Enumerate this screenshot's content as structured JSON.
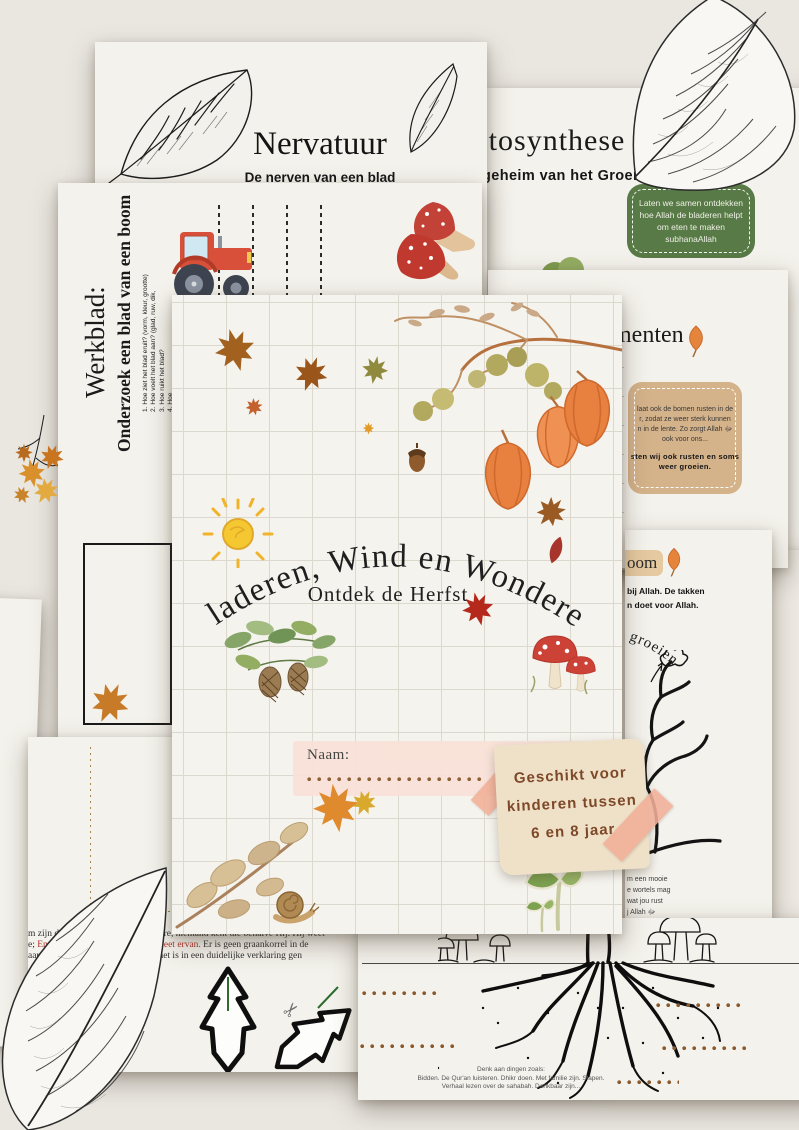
{
  "cover": {
    "title": "Bladeren, Wind en Wonderen",
    "subtitle": "Ontdek de Herfst",
    "name_label": "Naam:",
    "note_lines": [
      "Geschikt voor",
      "kinderen tussen",
      "6 en 8 jaar"
    ]
  },
  "nervatuur": {
    "title": "Nervatuur",
    "subtitle": "De nerven van een blad"
  },
  "fotosynthese": {
    "title": "Fotosynthese",
    "subtitle": "Het geheim van het Groene Blad",
    "badge_lines": [
      "Laten we samen ontdekken",
      "hoe Allah de bladeren helpt",
      "om eten te maken",
      "subhanaAllah"
    ]
  },
  "werkblad": {
    "title": "Werkblad:",
    "subtitle": "Onderzoek een blad van een boom",
    "items": [
      "1.  Hoe ziet het blad eruit? (vorm, kleur, grootte)",
      "2.  Hoe voelt het blad aan? (glad, ruw, dik,",
      "3.  Hoe ruikt het blad?",
      "4.  Hoe"
    ]
  },
  "experimenten": {
    "title_partial": "menten",
    "box_lines": [
      "laat ook de bomen rusten in de",
      "r, zodat ze weer sterk kunnen",
      "n in de lente. Zo zorgt Allah ﷻ",
      "ook voor ons..."
    ],
    "box_bold_lines": [
      "sten wij ook rusten en soms",
      "weer groeien."
    ]
  },
  "boom": {
    "badge_partial": "oom",
    "line1": "bij Allah. De takken",
    "line2": "n doet voor Allah.",
    "arc_text": "groeien",
    "bottom_lines": [
      "m een mooie",
      "e wortels mag",
      "wat jou rust",
      "j Allah ﷻ"
    ]
  },
  "ayah": {
    "arabic_line1": "وَيَعْلَمُ مَا",
    "arabic_line2": "إِلَّا يَعْلَمُهَا",
    "arabic_line3": "وَلَا يَابِسٍ",
    "trans_line1": "m zijn de sleutels van het onzichtbare, niemand kent die behalve Hij. Hij weet",
    "trans_line2_pre": "e; ",
    "trans_line2_red": "En er valt nog geen blad of Hij weet ervan.",
    "trans_line2_post": " Er is geen graankorrel in de",
    "trans_line3": "aarde, noch iets' vers of droogs of het is in een duidelijke verklaring gen"
  },
  "roots": {
    "hint_lines": [
      "Denk aan dingen zoals:",
      "Bidden. De Qur'an luisteren. Dhikr doen. Met familie zijn. Slapen.",
      "Verhaal lezen over de sahabah. Dankbaar zijn..."
    ]
  },
  "icons": {
    "scissors": "✂"
  },
  "colors": {
    "background": "#eae7e1",
    "paper": "#f4f2ec",
    "badge_green": "#587a46",
    "box_tan": "#d4b28a",
    "pill_beige": "#e5c9a0",
    "tape_pink": "#f2b098",
    "note_beige": "#efe1c8",
    "name_strip_pink": "#f9e2d8",
    "dot_brown": "#8a5a2e",
    "red_text": "#b13328",
    "gold_arabic": "#a8741a"
  }
}
